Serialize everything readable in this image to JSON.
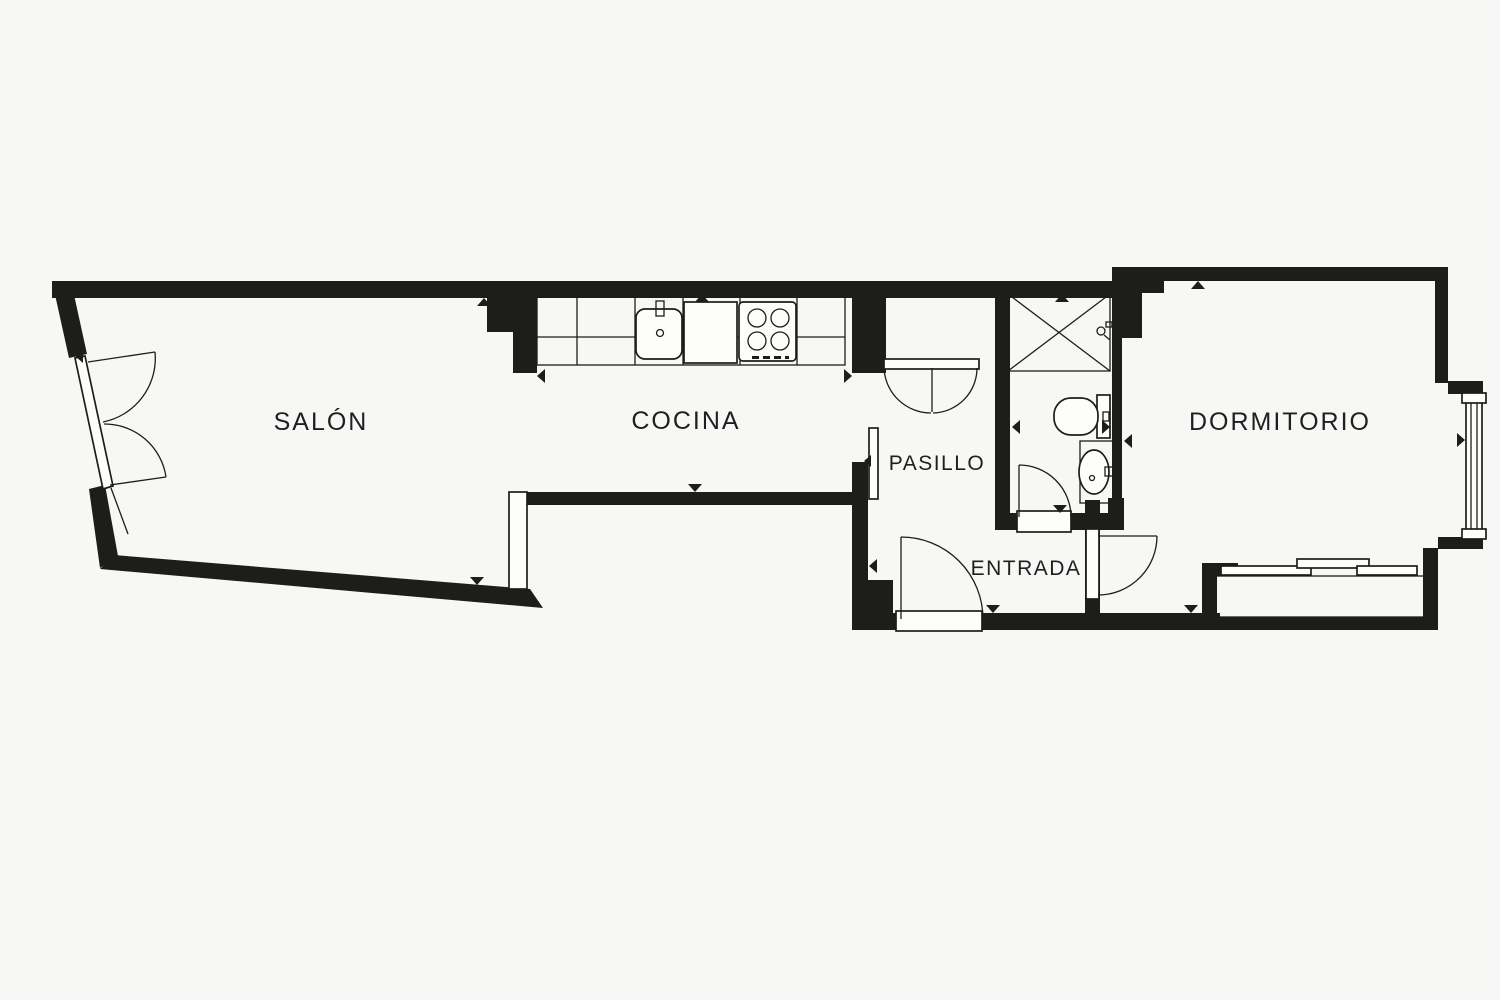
{
  "plan": {
    "type": "apartment-floor-plan",
    "background_color": "#f7f7f5",
    "wall_color": "#1d1d1b",
    "fixture_fill_color": "#fdfdfc",
    "label_color": "#1f1f1f"
  },
  "rooms": [
    {
      "id": "salon",
      "label": "SALÓN"
    },
    {
      "id": "cocina",
      "label": "COCINA"
    },
    {
      "id": "pasillo",
      "label": "PASILLO"
    },
    {
      "id": "entrada",
      "label": "ENTRADA"
    },
    {
      "id": "dormitorio",
      "label": "DORMITORIO"
    }
  ],
  "fixtures": [
    "balcony-french-door",
    "kitchen-counter",
    "kitchen-sink",
    "cooktop",
    "closet-double-doors",
    "shower",
    "shower-head",
    "toilet",
    "washbasin",
    "bathroom-door",
    "entry-door",
    "bedroom-door",
    "bedroom-window",
    "balcony-sliding-window",
    "wall-opening-markers"
  ],
  "icons": {
    "opening-marker": "filled-triangle",
    "burner": "circle-outline",
    "door-swing": "quarter-arc"
  }
}
